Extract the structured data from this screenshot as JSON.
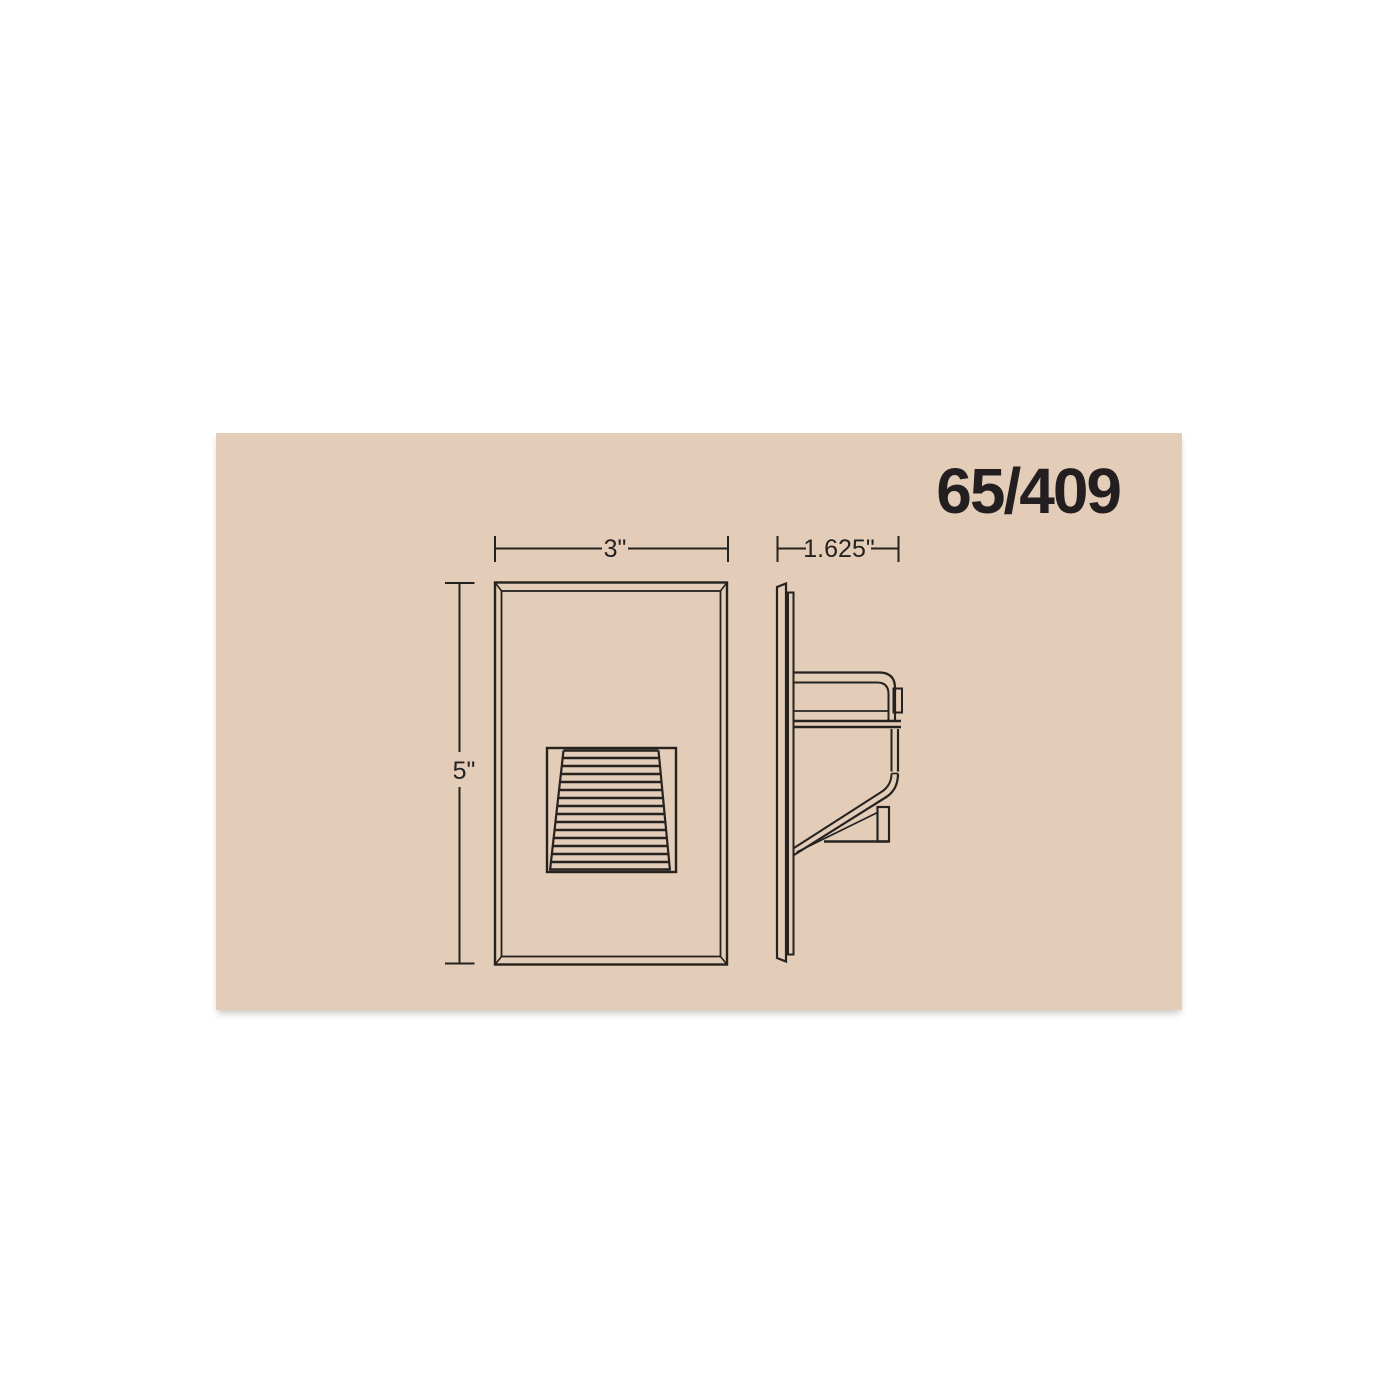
{
  "header": {
    "product_code": "65/409"
  },
  "dimensions": {
    "front_width": {
      "label": "3\""
    },
    "front_height": {
      "label": "5\""
    },
    "side_depth": {
      "label": "1.625\""
    }
  },
  "colors": {
    "page_background": "#ffffff",
    "panel_background": "#e3cdb8",
    "line": "#262220",
    "text": "#231f20"
  }
}
